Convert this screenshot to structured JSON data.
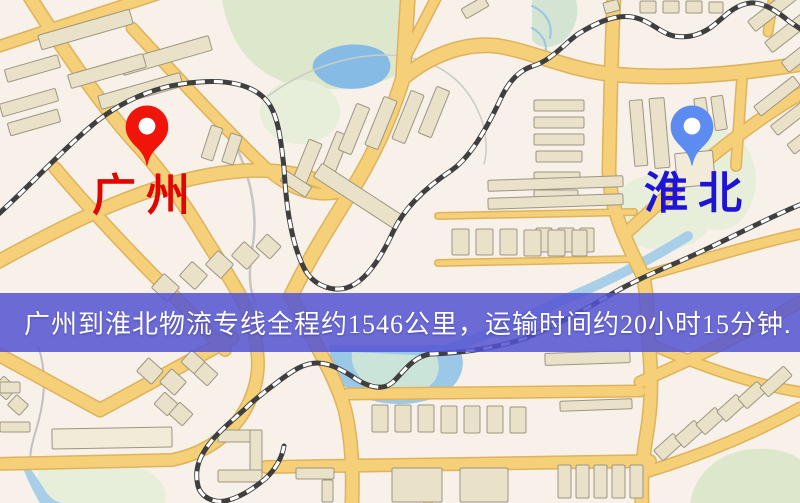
{
  "banner": {
    "text": "广州到淮北物流专线全程约1546公里，运输时间约20小时15分钟.",
    "bg": "rgba(84,84,210,0.85)",
    "fg": "#FFFFFF"
  },
  "markers": [
    {
      "id": "guangzhou",
      "label": "广州",
      "x": 147,
      "tip_y": 168,
      "color": "#F0140A",
      "label_color": "#E00500",
      "label_x": 92,
      "label_y": 172
    },
    {
      "id": "huaibei",
      "label": "淮北",
      "x": 692,
      "tip_y": 168,
      "color": "#5C8CF0",
      "label_color": "#1F13D8",
      "label_x": 644,
      "label_y": 170
    }
  ],
  "palette": {
    "bg": "#F7F1EA",
    "road_fill": "#F5D078",
    "road_edge": "#DFB25C",
    "rail_dark": "#3F3F3F",
    "rail_light": "#FFFFFF",
    "building": "#EAE2C8",
    "building_edge": "#9C9582",
    "building_light": "#F1EBD8",
    "green": "#DCE7CC",
    "green_pale": "#E7EED9",
    "green_teal": "#D3E5D2",
    "water": "#86BBE5",
    "water_light": "#A9CFE8",
    "pond": "#9CC8E8",
    "pond_inner": "#CBE4D9"
  },
  "map": {
    "green": [
      {
        "d": "M222,0 L400,0 C415,20 420,45 410,62 C395,85 350,92 310,88 C280,85 255,70 240,48 C230,32 224,14 222,0 Z",
        "fill": "green"
      },
      {
        "ellipse": [
          300,
          112,
          40,
          32
        ],
        "fill": "green_pale"
      },
      {
        "d": "M532,0 L576,0 C580,15 575,32 562,42 C550,50 538,48 532,40 Z",
        "fill": "green_teal"
      },
      {
        "ellipse": [
          662,
          212,
          52,
          38
        ],
        "fill": "green_pale"
      },
      {
        "ellipse": [
          718,
          180,
          38,
          50
        ],
        "fill": "green_pale"
      },
      {
        "d": "M40,465 C70,455 110,458 140,468 C160,475 168,488 165,503 L45,503 C38,490 36,475 40,465 Z",
        "fill": "green_pale"
      },
      {
        "d": "M690,503 C695,475 715,455 745,450 C770,446 792,452 800,460 L800,503 Z",
        "fill": "green"
      }
    ],
    "water": [
      {
        "d": "M316,58 C330,44 360,40 380,50 C392,57 394,70 384,79 C368,92 336,92 322,80 C312,72 310,66 316,58 Z",
        "fill": "water"
      },
      {
        "d": "M688,236 C650,260 610,280 568,298 C540,310 510,325 482,336 C462,344 448,350 436,352",
        "stroke": "water_light",
        "w": 10
      },
      {
        "d": "M330,345 C328,362 334,380 352,392 C372,405 408,408 434,398 C456,390 466,372 462,356 C460,348 456,345 452,345 Z",
        "fill": "pond"
      },
      {
        "d": "M352,352 C350,366 358,380 374,388 C390,395 412,395 426,388 C438,382 442,368 436,356 Z",
        "fill": "pond_inner"
      },
      {
        "d": "M22,458 C32,470 40,482 46,492 C52,500 58,503 64,503 L40,503 C32,490 24,472 20,460 Z",
        "fill": "water_light"
      }
    ],
    "streams": [
      {
        "d": "M226,126 C248,166 260,208 252,250 C248,276 250,292 256,304",
        "w": 2.5,
        "c": "#C6C6C6"
      },
      {
        "d": "M268,96 C320,58 382,46 426,62 C456,73 472,94 481,118 C486,132 488,150 484,164",
        "w": 1.5,
        "c": "#C9CDC5"
      },
      {
        "d": "M532,6 C546,12 553,24 550,38",
        "w": 2,
        "c": "#9CC4E4"
      },
      {
        "d": "M532,28 C543,34 548,44 545,54",
        "w": 2,
        "c": "#9CC4E4"
      },
      {
        "d": "M38,346 C48,374 44,404 36,430 C31,447 29,457 31,463",
        "w": 2,
        "c": "#BFBFBF"
      }
    ],
    "roads": [
      {
        "d": "M-6,48 L158,-6",
        "w": 10
      },
      {
        "d": "M28,-6 C60,45 100,105 140,148 C162,172 186,206 206,240 C220,262 231,280 240,296",
        "w": 12
      },
      {
        "d": "M132,28 C180,80 226,130 268,170 C290,190 314,197 338,193",
        "w": 10
      },
      {
        "d": "M-6,264 C70,222 150,181 230,172 C281,166 316,177 346,193",
        "w": 12
      },
      {
        "d": "M55,168 C92,212 134,256 176,298 L225,350",
        "w": 11
      },
      {
        "d": "M-6,352 L100,410 L232,338",
        "w": 12
      },
      {
        "d": "M-6,464 L172,460 C212,452 238,428 250,400 C258,382 259,364 257,350 C256,332 248,312 240,296",
        "w": 11
      },
      {
        "d": "M408,-6 L403,78 C390,120 372,158 352,190 C332,222 308,260 291,296",
        "w": 13
      },
      {
        "d": "M291,296 C315,345 335,375 345,410 C352,440 353,470 352,503",
        "w": 12
      },
      {
        "d": "M403,78 C432,54 466,42 498,46 C534,52 570,70 610,74 C672,80 740,74 800,64",
        "w": 13
      },
      {
        "d": "M404,60 L438,-6",
        "w": 9
      },
      {
        "d": "M614,-6 C611,60 610,120 609,170 C610,214 630,248 643,276 C647,292 647,312 648,332 C651,366 653,396 647,432 C642,462 641,482 642,503",
        "w": 12
      },
      {
        "d": "M625,234 L700,166 C725,145 762,116 800,94",
        "w": 11
      },
      {
        "d": "M644,276 C695,262 750,245 800,234",
        "w": 9
      },
      {
        "d": "M742,78 L736,166",
        "w": 9
      },
      {
        "d": "M438,216 L634,212",
        "w": 5
      },
      {
        "d": "M438,263 L634,259",
        "w": 5
      },
      {
        "d": "M266,467 L650,461",
        "w": 11
      },
      {
        "d": "M348,394 L640,391",
        "w": 10
      },
      {
        "d": "M428,463 L428,503",
        "w": 7
      },
      {
        "d": "M640,382 C700,356 752,330 800,302",
        "w": 10
      },
      {
        "d": "M646,472 C706,454 760,430 800,408",
        "w": 10
      },
      {
        "d": "M652,345 C705,368 755,385 800,392",
        "w": 9
      },
      {
        "d": "M774,-6 L768,32",
        "w": 8
      }
    ],
    "rails": [
      {
        "d": "M-8,220 C30,186 62,150 96,122 C130,95 166,84 200,82 C226,80 252,84 266,100 C278,113 281,140 284,168 C286,202 290,240 304,268 C312,284 330,292 346,288 C364,283 380,260 393,232 C405,206 428,186 452,170 C472,156 490,122 502,96 C510,80 520,70 533,66 C552,60 564,44 578,34 C594,24 614,14 632,17 C650,20 660,33 674,36 C690,39 704,33 714,25 C724,17 734,5 750,3 C764,2 778,12 790,22 L802,30"
      },
      {
        "d": "M802,204 C762,220 722,243 676,263 C650,274 631,283 615,292 C586,309 556,326 526,338 C497,348 462,353 430,354 C412,357 402,374 393,382 C383,391 369,387 356,379 C344,371 331,363 317,363 C303,363 291,372 279,381 C263,393 253,401 247,407 C231,422 215,434 205,450 C197,462 195,474 198,486 C201,497 213,503 225,501 C239,498 253,489 265,479 C275,470 282,458 284,446"
      }
    ],
    "buildings": [
      [
        38,
        22,
        95,
        15,
        -16
      ],
      [
        120,
        48,
        92,
        15,
        -16
      ],
      [
        5,
        62,
        55,
        13,
        -16
      ],
      [
        68,
        64,
        78,
        14,
        -16
      ],
      [
        98,
        84,
        85,
        14,
        -16
      ],
      [
        0,
        96,
        58,
        13,
        -16
      ],
      [
        8,
        116,
        52,
        13,
        -16
      ],
      [
        206,
        126,
        12,
        34,
        18
      ],
      [
        226,
        134,
        12,
        30,
        18
      ],
      [
        300,
        140,
        14,
        46,
        22
      ],
      [
        327,
        132,
        14,
        49,
        22
      ],
      [
        347,
        104,
        14,
        50,
        22
      ],
      [
        374,
        97,
        14,
        52,
        22
      ],
      [
        401,
        91,
        14,
        52,
        22
      ],
      [
        427,
        87,
        14,
        50,
        22
      ],
      [
        310,
        188,
        96,
        16,
        33
      ],
      [
        281,
        178,
        30,
        12,
        33
      ],
      [
        604,
        1,
        15,
        11,
        -15
      ],
      [
        640,
        1,
        16,
        12,
        0
      ],
      [
        663,
        1,
        16,
        12,
        0
      ],
      [
        686,
        1,
        16,
        12,
        0
      ],
      [
        709,
        2,
        14,
        11,
        0
      ],
      [
        462,
        2,
        26,
        11,
        -30
      ],
      [
        746,
        4,
        52,
        13,
        -38
      ],
      [
        763,
        25,
        52,
        13,
        -38
      ],
      [
        780,
        46,
        48,
        13,
        -38
      ],
      [
        752,
        90,
        50,
        12,
        -38
      ],
      [
        769,
        110,
        48,
        12,
        -38
      ],
      [
        786,
        130,
        44,
        12,
        -38
      ],
      [
        534,
        100,
        50,
        11,
        0
      ],
      [
        534,
        117,
        50,
        11,
        0
      ],
      [
        534,
        134,
        50,
        11,
        0
      ],
      [
        536,
        151,
        46,
        11,
        0
      ],
      [
        534,
        172,
        46,
        11,
        0
      ],
      [
        534,
        190,
        44,
        11,
        0
      ],
      [
        536,
        228,
        16,
        24,
        0
      ],
      [
        558,
        228,
        16,
        24,
        0
      ],
      [
        580,
        228,
        14,
        24,
        0
      ],
      [
        632,
        100,
        13,
        66,
        -5
      ],
      [
        652,
        98,
        15,
        70,
        -5
      ],
      [
        676,
        152,
        38,
        34,
        -5,
        "light"
      ],
      [
        696,
        98,
        12,
        34,
        -8
      ],
      [
        713,
        96,
        12,
        34,
        -8
      ],
      [
        488,
        178,
        135,
        11,
        -2
      ],
      [
        488,
        196,
        135,
        11,
        -2
      ],
      [
        452,
        229,
        17,
        26,
        0
      ],
      [
        476,
        229,
        17,
        26,
        0
      ],
      [
        500,
        229,
        17,
        26,
        0
      ],
      [
        524,
        230,
        17,
        26,
        0
      ],
      [
        548,
        230,
        17,
        26,
        0
      ],
      [
        572,
        230,
        15,
        26,
        0
      ],
      [
        155,
        278,
        21,
        19,
        42
      ],
      [
        183,
        266,
        21,
        19,
        42
      ],
      [
        209,
        255,
        21,
        19,
        42
      ],
      [
        235,
        246,
        21,
        19,
        42
      ],
      [
        259,
        238,
        19,
        17,
        42
      ],
      [
        140,
        362,
        20,
        18,
        42
      ],
      [
        163,
        373,
        20,
        18,
        42
      ],
      [
        184,
        354,
        18,
        16,
        42
      ],
      [
        197,
        366,
        18,
        16,
        42
      ],
      [
        157,
        396,
        18,
        16,
        42
      ],
      [
        172,
        406,
        18,
        16,
        42
      ],
      [
        -4,
        380,
        18,
        16,
        42
      ],
      [
        10,
        398,
        16,
        14,
        42
      ],
      [
        52,
        428,
        120,
        20,
        -1,
        "light"
      ],
      [
        218,
        430,
        44,
        12,
        0
      ],
      [
        250,
        430,
        12,
        52,
        0
      ],
      [
        218,
        470,
        44,
        12,
        0
      ],
      [
        296,
        468,
        38,
        11,
        0
      ],
      [
        322,
        480,
        11,
        22,
        0
      ],
      [
        372,
        405,
        16,
        27,
        0
      ],
      [
        395,
        405,
        16,
        27,
        0
      ],
      [
        418,
        405,
        16,
        27,
        0
      ],
      [
        441,
        406,
        16,
        27,
        0
      ],
      [
        464,
        406,
        16,
        27,
        0
      ],
      [
        487,
        406,
        16,
        27,
        0
      ],
      [
        510,
        407,
        16,
        26,
        0
      ],
      [
        392,
        468,
        50,
        34,
        0
      ],
      [
        460,
        468,
        48,
        34,
        0
      ],
      [
        558,
        465,
        13,
        33,
        0
      ],
      [
        576,
        465,
        13,
        33,
        0
      ],
      [
        594,
        465,
        13,
        33,
        0
      ],
      [
        612,
        465,
        13,
        33,
        0
      ],
      [
        630,
        465,
        13,
        33,
        0
      ],
      [
        545,
        352,
        85,
        12,
        -2
      ],
      [
        560,
        400,
        72,
        10,
        -2
      ],
      [
        655,
        440,
        26,
        14,
        -42
      ],
      [
        676,
        427,
        26,
        14,
        -42
      ],
      [
        697,
        414,
        26,
        14,
        -42
      ],
      [
        718,
        401,
        26,
        14,
        -42
      ],
      [
        739,
        388,
        26,
        14,
        -42
      ],
      [
        760,
        375,
        32,
        13,
        -42
      ],
      [
        0,
        382,
        20,
        11,
        0
      ],
      [
        0,
        422,
        30,
        10,
        0
      ]
    ]
  }
}
